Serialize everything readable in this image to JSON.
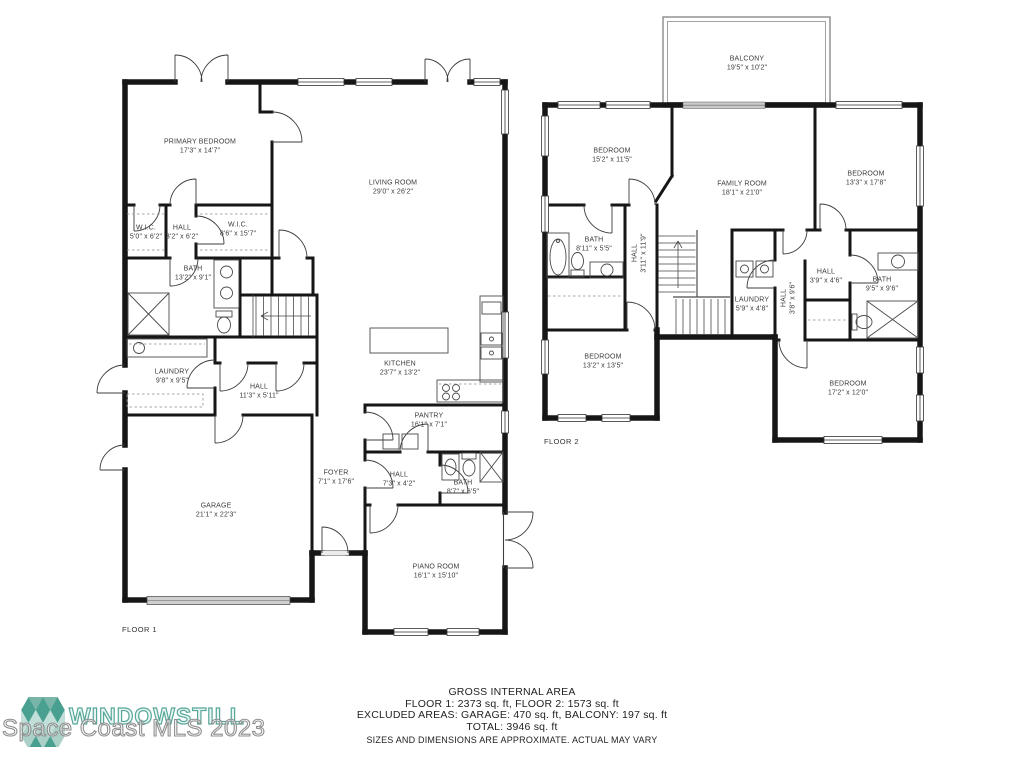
{
  "floor1": {
    "label": "FLOOR 1",
    "rooms": [
      {
        "name": "PRIMARY BEDROOM",
        "dims": "17'3\" x 14'7\""
      },
      {
        "name": "LIVING ROOM",
        "dims": "29'0\" x 26'2\""
      },
      {
        "name": "W.I.C.",
        "dims": "5'0\" x 6'2\""
      },
      {
        "name": "HALL",
        "dims": "3'2\" x 6'2\""
      },
      {
        "name": "W.I.C.",
        "dims": "8'6\" x 15'7\""
      },
      {
        "name": "BATH",
        "dims": "13'2\" x 9'1\""
      },
      {
        "name": "LAUNDRY",
        "dims": "9'8\" x 9'5\""
      },
      {
        "name": "HALL",
        "dims": "11'3\" x 5'11\""
      },
      {
        "name": "KITCHEN",
        "dims": "23'7\" x 13'2\""
      },
      {
        "name": "PANTRY",
        "dims": "16'1\" x 7'1\""
      },
      {
        "name": "FOYER",
        "dims": "7'1\" x 17'6\""
      },
      {
        "name": "HALL",
        "dims": "7'3\" x 4'2\""
      },
      {
        "name": "BATH",
        "dims": "8'7\" x 6'5\""
      },
      {
        "name": "GARAGE",
        "dims": "21'1\" x 22'3\""
      },
      {
        "name": "PIANO ROOM",
        "dims": "16'1\" x 15'10\""
      }
    ]
  },
  "floor2": {
    "label": "FLOOR 2",
    "rooms": [
      {
        "name": "BALCONY",
        "dims": "19'5\" x 10'2\""
      },
      {
        "name": "BEDROOM",
        "dims": "15'2\" x 11'5\""
      },
      {
        "name": "FAMILY ROOM",
        "dims": "18'1\" x 21'0\""
      },
      {
        "name": "BEDROOM",
        "dims": "13'3\" x 17'8\""
      },
      {
        "name": "BATH",
        "dims": "8'11\" x 5'5\""
      },
      {
        "name": "HALL",
        "dims": "3'11\" x 11'9\""
      },
      {
        "name": "LAUNDRY",
        "dims": "5'9\" x 4'8\""
      },
      {
        "name": "HALL",
        "dims": "3'8\" x 9'6\""
      },
      {
        "name": "HALL",
        "dims": "3'9\" x 4'6\""
      },
      {
        "name": "BATH",
        "dims": "9'5\" x 9'6\""
      },
      {
        "name": "BEDROOM",
        "dims": "13'2\" x 13'5\""
      },
      {
        "name": "BEDROOM",
        "dims": "17'2\" x 12'0\""
      }
    ]
  },
  "footer": {
    "line1": "GROSS INTERNAL AREA",
    "line2": "FLOOR 1: 2373 sq. ft, FLOOR 2: 1573 sq. ft",
    "line3": "EXCLUDED AREAS: GARAGE: 470 sq. ft, BALCONY: 197 sq. ft",
    "line4": "TOTAL: 3946 sq. ft",
    "line5": "SIZES AND DIMENSIONS ARE APPROXIMATE. ACTUAL MAY VARY"
  },
  "watermark": {
    "brand": "WINDOWSTILL",
    "mls": "Space Coast MLS 2023",
    "colors": {
      "teal_dark": "#49a091",
      "teal_mid": "#7ab5aa",
      "teal_light": "#abd0c8",
      "teal_pale": "#c2ded8",
      "gray": "#8f8f8f"
    }
  }
}
